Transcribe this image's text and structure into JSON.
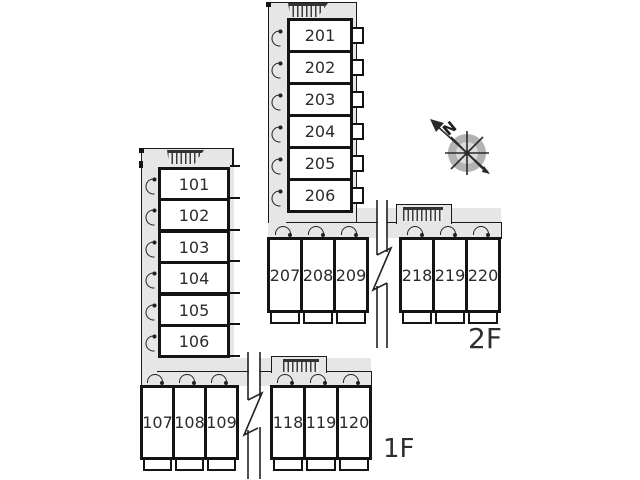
{
  "floor_2f": {
    "label": "2F",
    "vertical_rooms": [
      "201",
      "202",
      "203",
      "204",
      "205",
      "206"
    ],
    "row_left_rooms": [
      "207",
      "208",
      "209"
    ],
    "row_right_rooms": [
      "218",
      "219",
      "220"
    ]
  },
  "floor_1f": {
    "label": "1F",
    "vertical_rooms": [
      "101",
      "102",
      "103",
      "104",
      "105",
      "106"
    ],
    "row_left_rooms": [
      "107",
      "108",
      "109"
    ],
    "row_right_rooms": [
      "118",
      "119",
      "120"
    ]
  },
  "compass": {
    "north_label": "N"
  },
  "colors": {
    "corridor_gray": "#e6e6e6",
    "wall": "#141414"
  }
}
